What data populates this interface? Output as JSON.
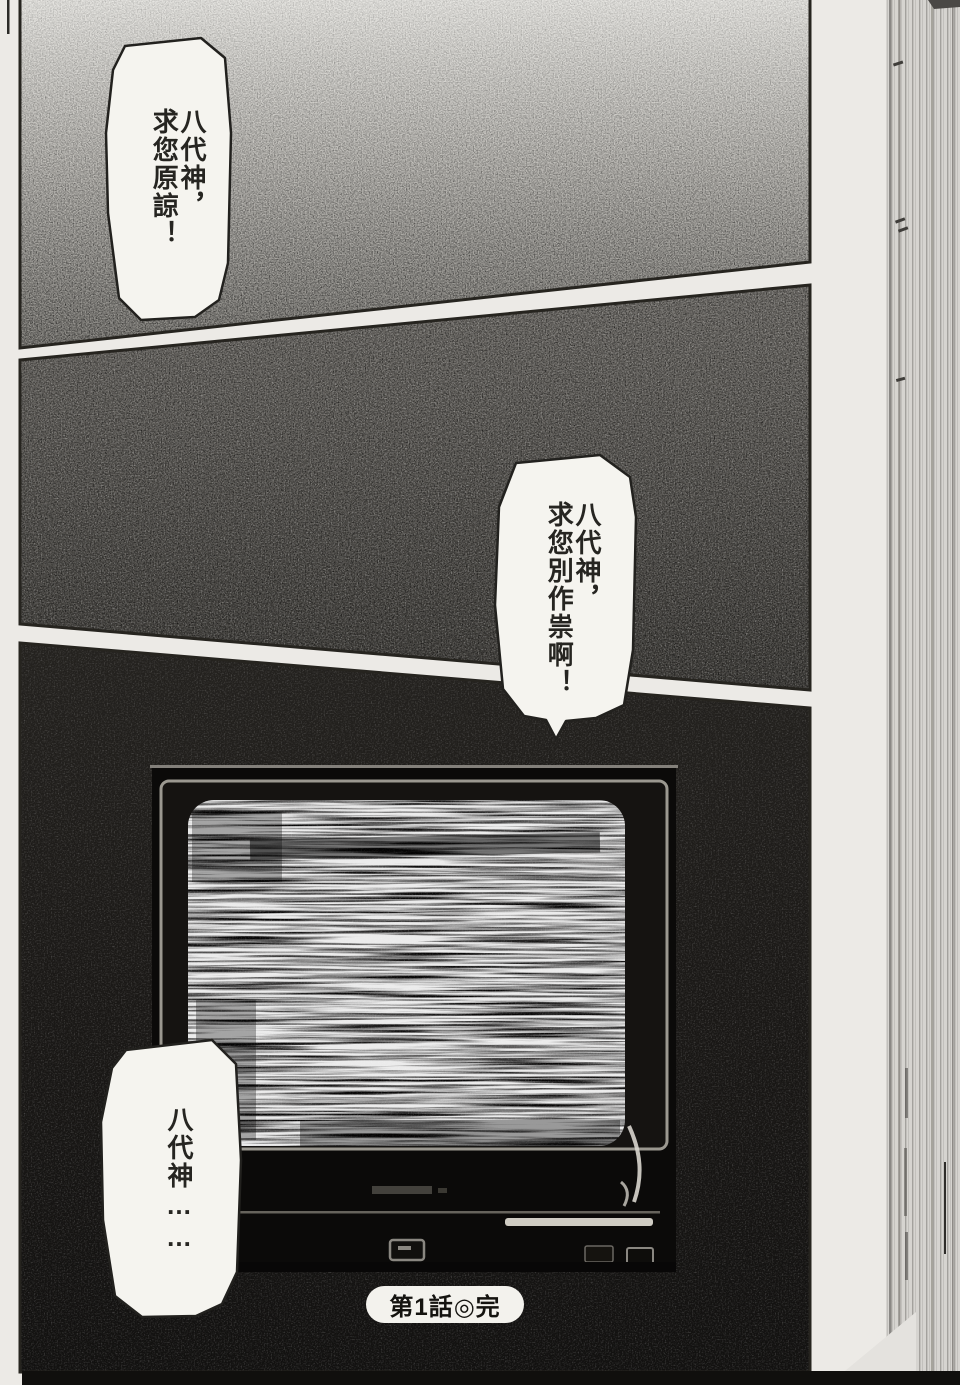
{
  "manga": {
    "page_kind": "manga-page-scan",
    "bubbles": [
      {
        "name": "bubble-top-left",
        "lines": [
          "八代神，",
          "求您原諒！"
        ]
      },
      {
        "name": "bubble-middle-right",
        "lines": [
          "八代神，",
          "求您別作祟啊！"
        ]
      },
      {
        "name": "bubble-bottom-left",
        "lines": [
          "八代神……"
        ]
      }
    ],
    "caption": {
      "text": "第1話◎完"
    }
  },
  "colors": {
    "page_margin": "#eceae6",
    "panel_ink": "#26241f",
    "panel1_top": "#e8e7e3",
    "panel1_bottom": "#8e8c87",
    "panel2_top": "#7d7a75",
    "panel2_bottom": "#45433f",
    "panel3_top": "#232120",
    "panel3_bottom": "#121110",
    "bubble_fill": "#f5f4ef",
    "text_ink": "#262521",
    "tv_frame_highlight": "#9b9890",
    "page_edge_base": "#d6d4d0"
  }
}
